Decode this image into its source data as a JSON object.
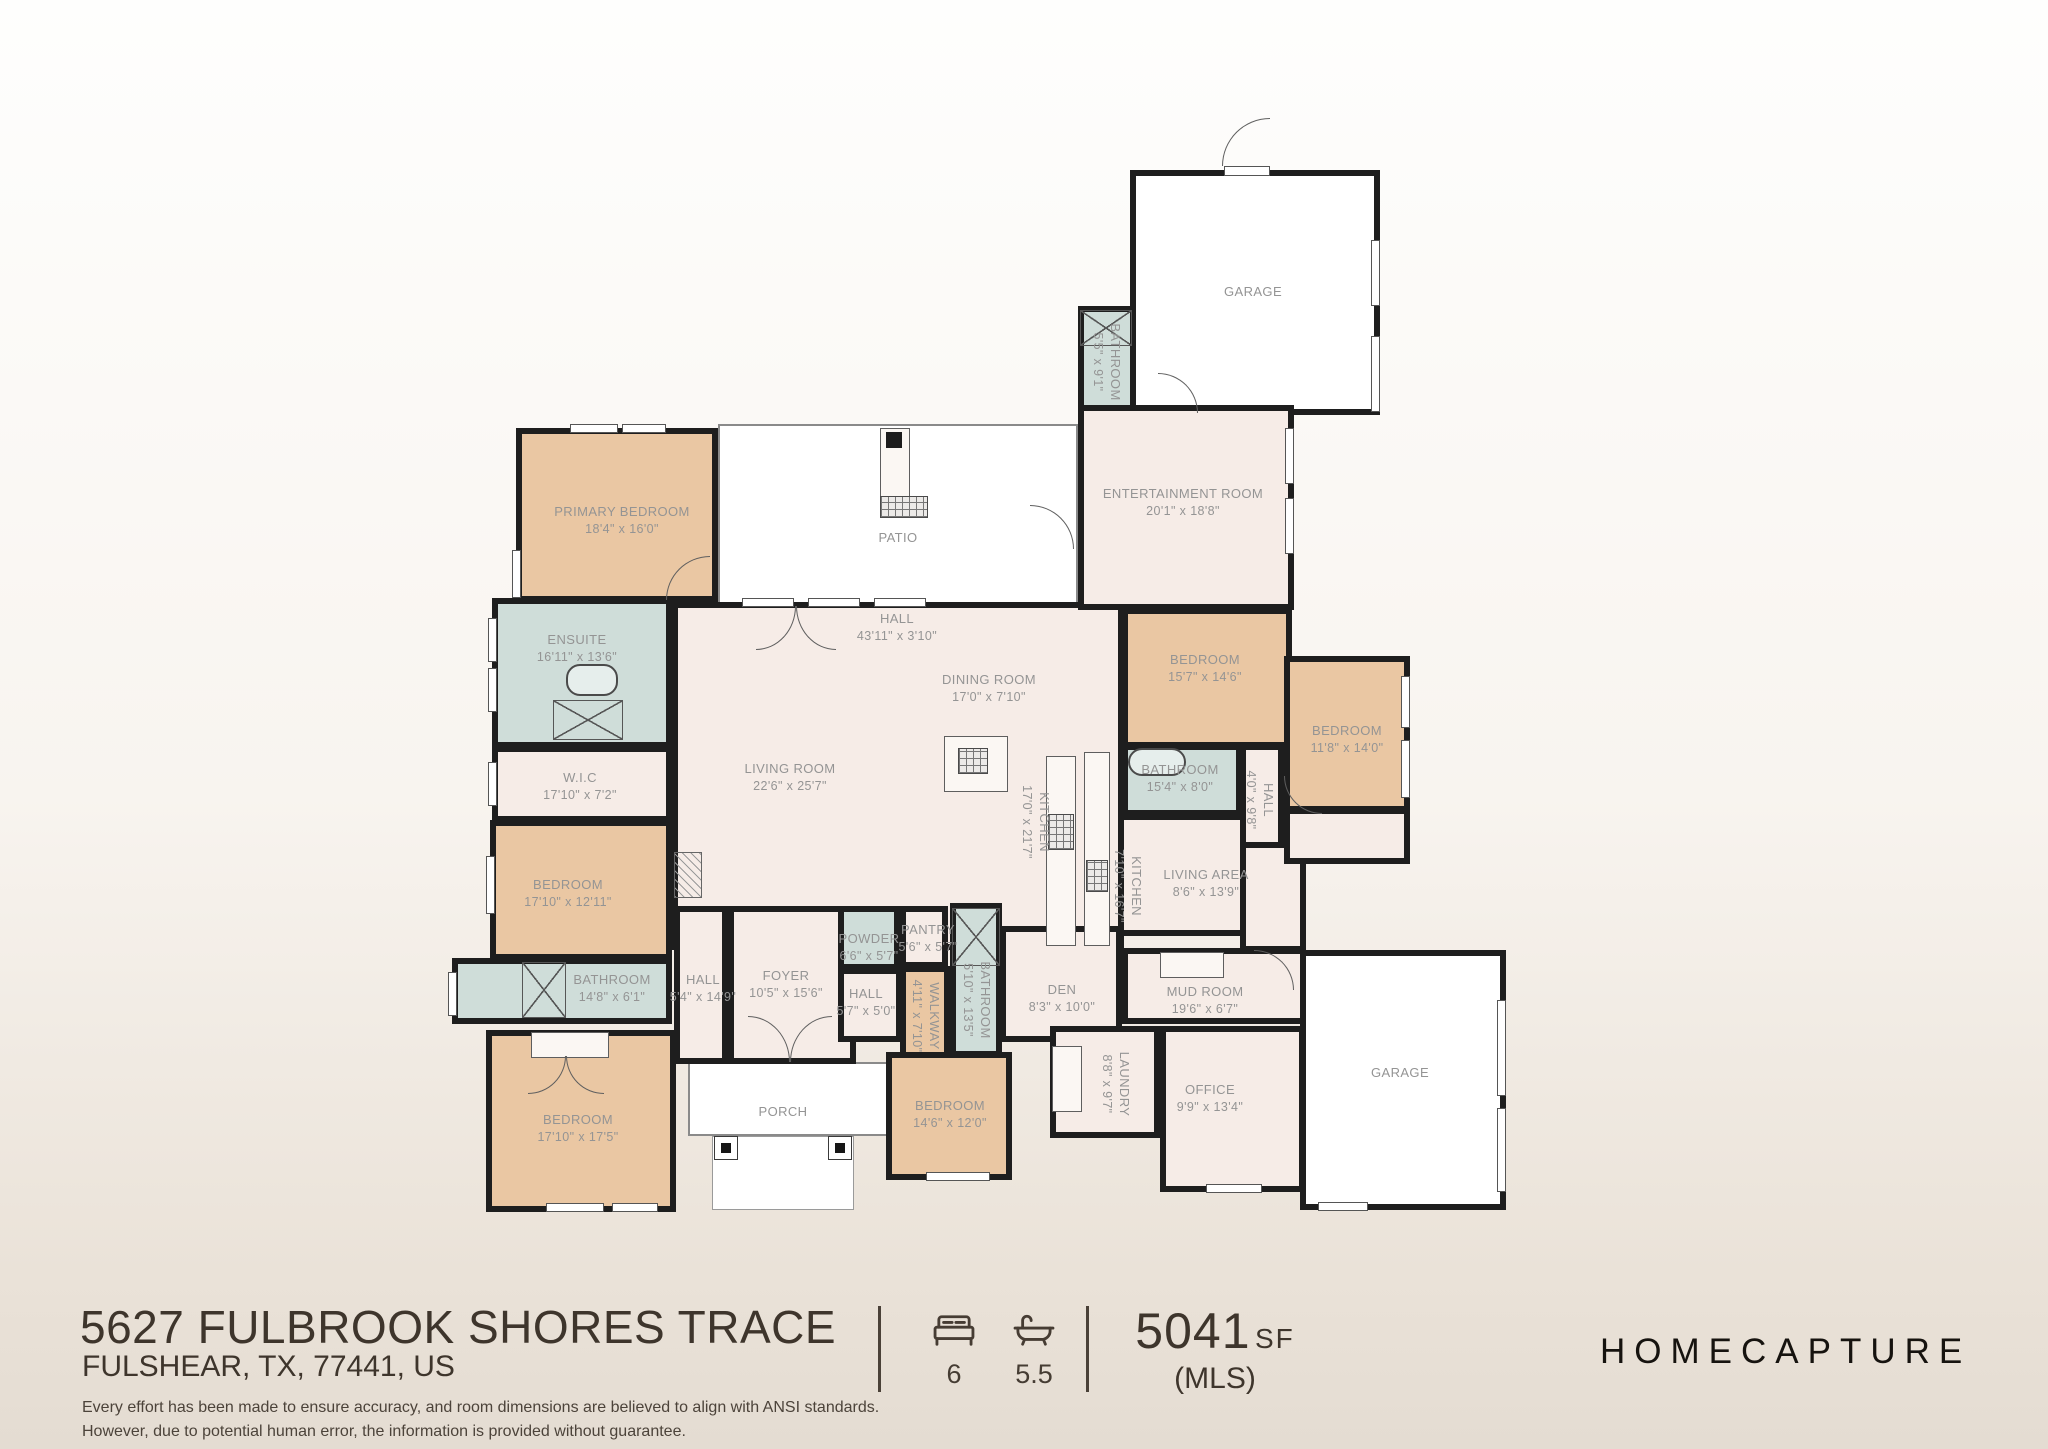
{
  "plan": {
    "rooms": [
      {
        "id": "patio",
        "fill": "open",
        "x": 718,
        "y": 424,
        "w": 360,
        "h": 180
      },
      {
        "id": "porch",
        "fill": "open",
        "x": 688,
        "y": 1062,
        "w": 202,
        "h": 74
      },
      {
        "id": "porch-steps",
        "fill": "open2",
        "x": 712,
        "y": 1136,
        "w": 142,
        "h": 74
      },
      {
        "id": "main-living",
        "fill": "pink",
        "x": 672,
        "y": 602,
        "w": 452,
        "h": 348
      },
      {
        "id": "living-area-block",
        "fill": "pink",
        "x": 1118,
        "y": 814,
        "w": 187,
        "h": 122
      },
      {
        "id": "filler-right",
        "fill": "pink",
        "x": 1240,
        "y": 840,
        "w": 66,
        "h": 112
      },
      {
        "id": "filler-right2",
        "fill": "pink",
        "x": 1284,
        "y": 808,
        "w": 126,
        "h": 56
      },
      {
        "id": "garage-top",
        "fill": "white",
        "x": 1130,
        "y": 170,
        "w": 250,
        "h": 245
      },
      {
        "id": "bathroom-top",
        "fill": "blue",
        "x": 1078,
        "y": 306,
        "w": 58,
        "h": 109
      },
      {
        "id": "entertainment-room",
        "fill": "pink",
        "x": 1078,
        "y": 405,
        "w": 216,
        "h": 205
      },
      {
        "id": "primary-bedroom",
        "fill": "tan",
        "x": 516,
        "y": 428,
        "w": 202,
        "h": 174
      },
      {
        "id": "ensuite",
        "fill": "blue",
        "x": 492,
        "y": 598,
        "w": 180,
        "h": 150
      },
      {
        "id": "wic",
        "fill": "pink",
        "x": 492,
        "y": 746,
        "w": 180,
        "h": 76
      },
      {
        "id": "bedroom-left",
        "fill": "tan",
        "x": 490,
        "y": 820,
        "w": 182,
        "h": 140
      },
      {
        "id": "bathroom-left",
        "fill": "blue",
        "x": 452,
        "y": 958,
        "w": 220,
        "h": 66
      },
      {
        "id": "bedroom-bottom-left",
        "fill": "tan",
        "x": 486,
        "y": 1030,
        "w": 190,
        "h": 182
      },
      {
        "id": "hall-left",
        "fill": "pink",
        "x": 674,
        "y": 906,
        "w": 54,
        "h": 158
      },
      {
        "id": "foyer",
        "fill": "pink",
        "x": 728,
        "y": 906,
        "w": 128,
        "h": 158
      },
      {
        "id": "powder",
        "fill": "blue",
        "x": 838,
        "y": 906,
        "w": 62,
        "h": 64
      },
      {
        "id": "pantry",
        "fill": "pink",
        "x": 900,
        "y": 906,
        "w": 48,
        "h": 62
      },
      {
        "id": "hall-center",
        "fill": "pink",
        "x": 838,
        "y": 968,
        "w": 64,
        "h": 74
      },
      {
        "id": "walkway",
        "fill": "tan",
        "x": 900,
        "y": 966,
        "w": 50,
        "h": 98
      },
      {
        "id": "bathroom-center",
        "fill": "blue",
        "x": 950,
        "y": 903,
        "w": 52,
        "h": 154
      },
      {
        "id": "den",
        "fill": "pink",
        "x": 1000,
        "y": 926,
        "w": 122,
        "h": 116
      },
      {
        "id": "mud-room",
        "fill": "pink",
        "x": 1122,
        "y": 948,
        "w": 184,
        "h": 76
      },
      {
        "id": "laundry",
        "fill": "pink",
        "x": 1050,
        "y": 1026,
        "w": 110,
        "h": 112
      },
      {
        "id": "office",
        "fill": "pink",
        "x": 1160,
        "y": 1026,
        "w": 145,
        "h": 166
      },
      {
        "id": "bedroom-bottom-center",
        "fill": "tan",
        "x": 886,
        "y": 1052,
        "w": 126,
        "h": 128
      },
      {
        "id": "bedroom-right-1",
        "fill": "tan",
        "x": 1122,
        "y": 608,
        "w": 170,
        "h": 140
      },
      {
        "id": "bedroom-right-2",
        "fill": "tan",
        "x": 1284,
        "y": 656,
        "w": 126,
        "h": 156
      },
      {
        "id": "bathroom-right",
        "fill": "blue",
        "x": 1122,
        "y": 744,
        "w": 120,
        "h": 72
      },
      {
        "id": "hall-right",
        "fill": "pink",
        "x": 1240,
        "y": 744,
        "w": 44,
        "h": 104
      },
      {
        "id": "garage-bottom",
        "fill": "white",
        "x": 1300,
        "y": 950,
        "w": 206,
        "h": 260
      }
    ],
    "labels": [
      {
        "id": "garage-top",
        "text": "GARAGE",
        "dims": "",
        "x": 1253,
        "y": 292,
        "v": false
      },
      {
        "id": "bathroom-top",
        "text": "BATHROOM",
        "dims": "5'5\" x 9'1\"",
        "x": 1107,
        "y": 362,
        "v": true
      },
      {
        "id": "entertainment-room",
        "text": "ENTERTAINMENT ROOM",
        "dims": "20'1\" x 18'8\"",
        "x": 1183,
        "y": 502,
        "v": false
      },
      {
        "id": "primary-bedroom",
        "text": "PRIMARY BEDROOM",
        "dims": "18'4\" x 16'0\"",
        "x": 622,
        "y": 520,
        "v": false
      },
      {
        "id": "patio",
        "text": "PATIO",
        "dims": "",
        "x": 898,
        "y": 538,
        "v": false
      },
      {
        "id": "ensuite",
        "text": "ENSUITE",
        "dims": "16'11\" x 13'6\"",
        "x": 577,
        "y": 648,
        "v": false
      },
      {
        "id": "hall-top",
        "text": "HALL",
        "dims": "43'11\" x 3'10\"",
        "x": 897,
        "y": 627,
        "v": false
      },
      {
        "id": "dining-room",
        "text": "DINING ROOM",
        "dims": "17'0\" x 7'10\"",
        "x": 989,
        "y": 688,
        "v": false
      },
      {
        "id": "living-room",
        "text": "LIVING ROOM",
        "dims": "22'6\" x 25'7\"",
        "x": 790,
        "y": 777,
        "v": false
      },
      {
        "id": "wic",
        "text": "W.I.C",
        "dims": "17'10\" x 7'2\"",
        "x": 580,
        "y": 786,
        "v": false
      },
      {
        "id": "bedroom-right-1",
        "text": "BEDROOM",
        "dims": "15'7\" x 14'6\"",
        "x": 1205,
        "y": 668,
        "v": false
      },
      {
        "id": "bedroom-right-2",
        "text": "BEDROOM",
        "dims": "11'8\" x 14'0\"",
        "x": 1347,
        "y": 739,
        "v": false
      },
      {
        "id": "bathroom-right",
        "text": "BATHROOM",
        "dims": "15'4\" x 8'0\"",
        "x": 1180,
        "y": 778,
        "v": false
      },
      {
        "id": "hall-right",
        "text": "HALL",
        "dims": "4'0\" x 9'8\"",
        "x": 1260,
        "y": 800,
        "v": true
      },
      {
        "id": "kitchen-main",
        "text": "KITCHEN",
        "dims": "17'0\" x 21'7\"",
        "x": 1036,
        "y": 822,
        "v": true
      },
      {
        "id": "kitchen-2",
        "text": "KITCHEN",
        "dims": "7'10\" x 16'7\"",
        "x": 1128,
        "y": 886,
        "v": true
      },
      {
        "id": "living-area",
        "text": "LIVING AREA",
        "dims": "8'6\" x 13'9\"",
        "x": 1206,
        "y": 883,
        "v": false
      },
      {
        "id": "bedroom-left",
        "text": "BEDROOM",
        "dims": "17'10\" x 12'11\"",
        "x": 568,
        "y": 893,
        "v": false
      },
      {
        "id": "bathroom-left",
        "text": "BATHROOM",
        "dims": "14'8\" x 6'1\"",
        "x": 612,
        "y": 988,
        "v": false
      },
      {
        "id": "hall-left",
        "text": "HALL",
        "dims": "5'4\" x 14'9\"",
        "x": 703,
        "y": 988,
        "v": false
      },
      {
        "id": "foyer",
        "text": "FOYER",
        "dims": "10'5\" x 15'6\"",
        "x": 786,
        "y": 984,
        "v": false
      },
      {
        "id": "powder",
        "text": "POWDER",
        "dims": "6'6\" x 5'7\"",
        "x": 869,
        "y": 947,
        "v": false
      },
      {
        "id": "pantry",
        "text": "PANTRY",
        "dims": "5'6\" x 5'7\"",
        "x": 928,
        "y": 938,
        "v": false
      },
      {
        "id": "hall-center",
        "text": "HALL",
        "dims": "5'7\" x 5'0\"",
        "x": 866,
        "y": 1002,
        "v": false
      },
      {
        "id": "walkway",
        "text": "WALKWAY",
        "dims": "4'11\" x 7'10\"",
        "x": 926,
        "y": 1016,
        "v": true
      },
      {
        "id": "bathroom-center",
        "text": "BATHROOM",
        "dims": "5'10\" x 13'5\"",
        "x": 977,
        "y": 1000,
        "v": true
      },
      {
        "id": "den",
        "text": "DEN",
        "dims": "8'3\" x 10'0\"",
        "x": 1062,
        "y": 998,
        "v": false
      },
      {
        "id": "mud-room",
        "text": "MUD ROOM",
        "dims": "19'6\" x 6'7\"",
        "x": 1205,
        "y": 1000,
        "v": false
      },
      {
        "id": "laundry",
        "text": "LAUNDRY",
        "dims": "8'8\" x 9'7\"",
        "x": 1116,
        "y": 1084,
        "v": true
      },
      {
        "id": "office",
        "text": "OFFICE",
        "dims": "9'9\" x 13'4\"",
        "x": 1210,
        "y": 1098,
        "v": false
      },
      {
        "id": "bedroom-bottom-left",
        "text": "BEDROOM",
        "dims": "17'10\" x 17'5\"",
        "x": 578,
        "y": 1128,
        "v": false
      },
      {
        "id": "bedroom-bottom-center",
        "text": "BEDROOM",
        "dims": "14'6\" x 12'0\"",
        "x": 950,
        "y": 1114,
        "v": false
      },
      {
        "id": "porch",
        "text": "PORCH",
        "dims": "",
        "x": 783,
        "y": 1112,
        "v": false
      },
      {
        "id": "garage-bottom",
        "text": "GARAGE",
        "dims": "",
        "x": 1400,
        "y": 1073,
        "v": false
      }
    ],
    "windows": [
      [
        570,
        424,
        48,
        9
      ],
      [
        622,
        424,
        44,
        9
      ],
      [
        512,
        550,
        9,
        48
      ],
      [
        488,
        618,
        9,
        44
      ],
      [
        488,
        668,
        9,
        44
      ],
      [
        488,
        762,
        9,
        44
      ],
      [
        486,
        856,
        9,
        58
      ],
      [
        448,
        972,
        9,
        44
      ],
      [
        546,
        1203,
        58,
        9
      ],
      [
        612,
        1203,
        46,
        9
      ],
      [
        926,
        1172,
        64,
        9
      ],
      [
        742,
        598,
        52,
        9
      ],
      [
        808,
        598,
        52,
        9
      ],
      [
        874,
        598,
        52,
        9
      ],
      [
        1285,
        428,
        9,
        56
      ],
      [
        1285,
        498,
        9,
        56
      ],
      [
        1371,
        240,
        9,
        66
      ],
      [
        1371,
        336,
        9,
        76
      ],
      [
        1224,
        166,
        46,
        10
      ],
      [
        1401,
        676,
        9,
        52
      ],
      [
        1401,
        740,
        9,
        58
      ],
      [
        1497,
        1000,
        9,
        96
      ],
      [
        1497,
        1108,
        9,
        84
      ],
      [
        1318,
        1202,
        50,
        9
      ],
      [
        1206,
        1184,
        56,
        9
      ]
    ],
    "doors": [
      {
        "x": 1222,
        "y": 118,
        "w": 48,
        "h": 48,
        "c": "tl"
      },
      {
        "x": 756,
        "y": 606,
        "w": 40,
        "h": 44,
        "c": "br"
      },
      {
        "x": 796,
        "y": 606,
        "w": 40,
        "h": 44,
        "c": "bl"
      },
      {
        "x": 666,
        "y": 556,
        "w": 44,
        "h": 44,
        "c": "tl"
      },
      {
        "x": 1030,
        "y": 505,
        "w": 44,
        "h": 44,
        "c": "tr"
      },
      {
        "x": 1158,
        "y": 373,
        "w": 40,
        "h": 40,
        "c": "tr"
      },
      {
        "x": 748,
        "y": 1016,
        "w": 42,
        "h": 46,
        "c": "tr"
      },
      {
        "x": 790,
        "y": 1016,
        "w": 42,
        "h": 46,
        "c": "tl"
      },
      {
        "x": 528,
        "y": 1056,
        "w": 38,
        "h": 38,
        "c": "br"
      },
      {
        "x": 566,
        "y": 1056,
        "w": 38,
        "h": 38,
        "c": "bl"
      },
      {
        "x": 1284,
        "y": 776,
        "w": 38,
        "h": 38,
        "c": "bl"
      },
      {
        "x": 1254,
        "y": 950,
        "w": 40,
        "h": 40,
        "c": "tr"
      }
    ],
    "fixtures": [
      {
        "t": "xbox",
        "x": 1080,
        "y": 310,
        "w": 52,
        "h": 36
      },
      {
        "t": "xbox",
        "x": 553,
        "y": 700,
        "w": 70,
        "h": 40
      },
      {
        "t": "xbox",
        "x": 522,
        "y": 962,
        "w": 44,
        "h": 56
      },
      {
        "t": "xbox",
        "x": 952,
        "y": 908,
        "w": 48,
        "h": 58
      },
      {
        "t": "tub",
        "x": 566,
        "y": 664,
        "w": 52,
        "h": 32
      },
      {
        "t": "tub",
        "x": 1128,
        "y": 748,
        "w": 58,
        "h": 28
      },
      {
        "t": "counter",
        "x": 944,
        "y": 736,
        "w": 64,
        "h": 56
      },
      {
        "t": "counter",
        "x": 1046,
        "y": 756,
        "w": 30,
        "h": 190
      },
      {
        "t": "counter",
        "x": 1084,
        "y": 752,
        "w": 26,
        "h": 194
      },
      {
        "t": "counter",
        "x": 1160,
        "y": 952,
        "w": 64,
        "h": 26
      },
      {
        "t": "counter",
        "x": 1052,
        "y": 1046,
        "w": 30,
        "h": 66
      },
      {
        "t": "counter",
        "x": 531,
        "y": 1032,
        "w": 78,
        "h": 26
      },
      {
        "t": "counter",
        "x": 880,
        "y": 428,
        "w": 30,
        "h": 70
      },
      {
        "t": "grill",
        "x": 958,
        "y": 748,
        "w": 30,
        "h": 26
      },
      {
        "t": "grill",
        "x": 1048,
        "y": 814,
        "w": 26,
        "h": 36
      },
      {
        "t": "grill",
        "x": 1086,
        "y": 860,
        "w": 22,
        "h": 32
      },
      {
        "t": "grill",
        "x": 880,
        "y": 496,
        "w": 48,
        "h": 22
      },
      {
        "t": "post",
        "x": 714,
        "y": 1136,
        "w": 24,
        "h": 24
      },
      {
        "t": "post",
        "x": 828,
        "y": 1136,
        "w": 24,
        "h": 24
      },
      {
        "t": "blacksq",
        "x": 886,
        "y": 432,
        "w": 16,
        "h": 16
      },
      {
        "t": "hatch",
        "x": 674,
        "y": 852,
        "w": 28,
        "h": 46
      }
    ]
  },
  "footer": {
    "address_line1": "5627 FULBROOK SHORES TRACE",
    "address_line2": "FULSHEAR, TX, 77441, US",
    "beds": "6",
    "baths": "5.5",
    "area_value": "5041",
    "area_unit": "SF",
    "area_source": "(MLS)",
    "brand": "HOMECAPTURE",
    "disclaimer_line1": "Every effort has been made to ensure accuracy, and room dimensions are believed to align with ANSI standards.",
    "disclaimer_line2": "However, due to potential human error, the information is provided without guarantee."
  },
  "colors": {
    "wall": "#1e1e1e",
    "bedroom_fill": "#eac7a3",
    "bathroom_fill": "#cfddd9",
    "living_fill": "#f6ece7",
    "label_text": "#949494",
    "footer_text": "#3e352c"
  }
}
